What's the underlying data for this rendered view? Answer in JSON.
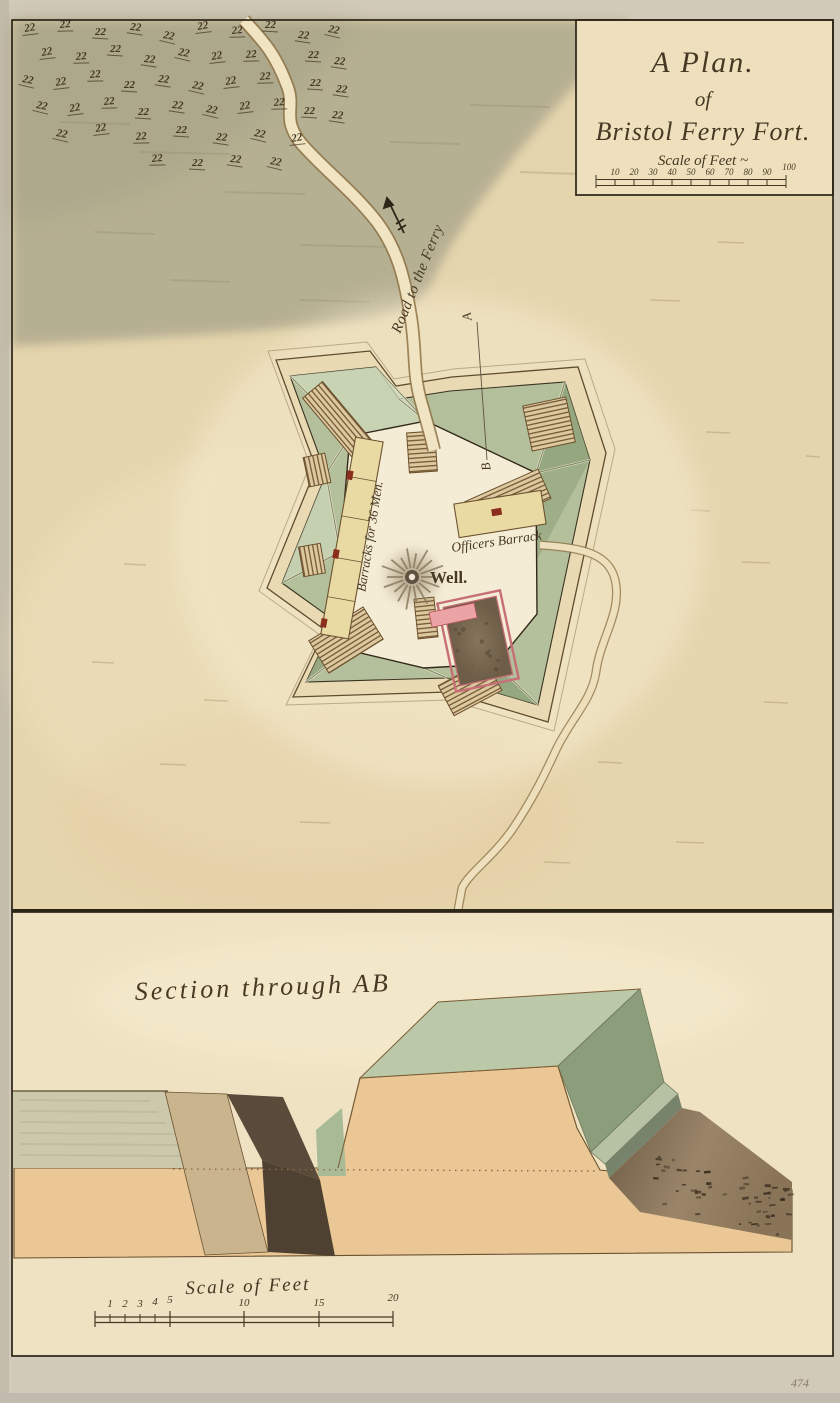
{
  "page": {
    "catalog_number": "474"
  },
  "title_block": {
    "title_line1": "A Plan.",
    "title_line2": "of",
    "title_line3": "Bristol Ferry Fort.",
    "scale_label": "Scale of Feet ~",
    "scale_ticks": [
      "10",
      "20",
      "30",
      "40",
      "50",
      "60",
      "70",
      "80",
      "90",
      "100"
    ]
  },
  "plan": {
    "road_label": "Road to the Ferry",
    "well_label": "Well.",
    "barracks_label": "Barracks for 36 Men.",
    "officers_barrack_label": "Officers Barrack",
    "section_point_a": "A",
    "section_point_b": "B",
    "tree_symbol": "22"
  },
  "section": {
    "title": "Section through AB",
    "scale_label": "Scale of Feet",
    "scale_ticks": [
      "1",
      "2",
      "3",
      "4",
      "5",
      "10",
      "15",
      "20"
    ]
  },
  "colors": {
    "paper": "#e5d5ad",
    "lower_panel": "#efe2c3",
    "margin": "#d2cab9",
    "ink": "#2b2416",
    "text_brown": "#463823",
    "woods_wash": "#b2ac90",
    "rampart_green": "#b3c09b",
    "rampart_green_dark": "#8da078",
    "parade": "#f5ecd6",
    "building_yellow": "#e9daa3",
    "ramp_tan": "#ddc9a0",
    "hatch_brown": "#6b4f2c",
    "magazine_pink": "#d98a90",
    "magazine_fill": "#7b6a52",
    "earth_orange": "#eac794",
    "ditch_dark": "#56483a",
    "ground_strip": "#ccc8ab"
  }
}
